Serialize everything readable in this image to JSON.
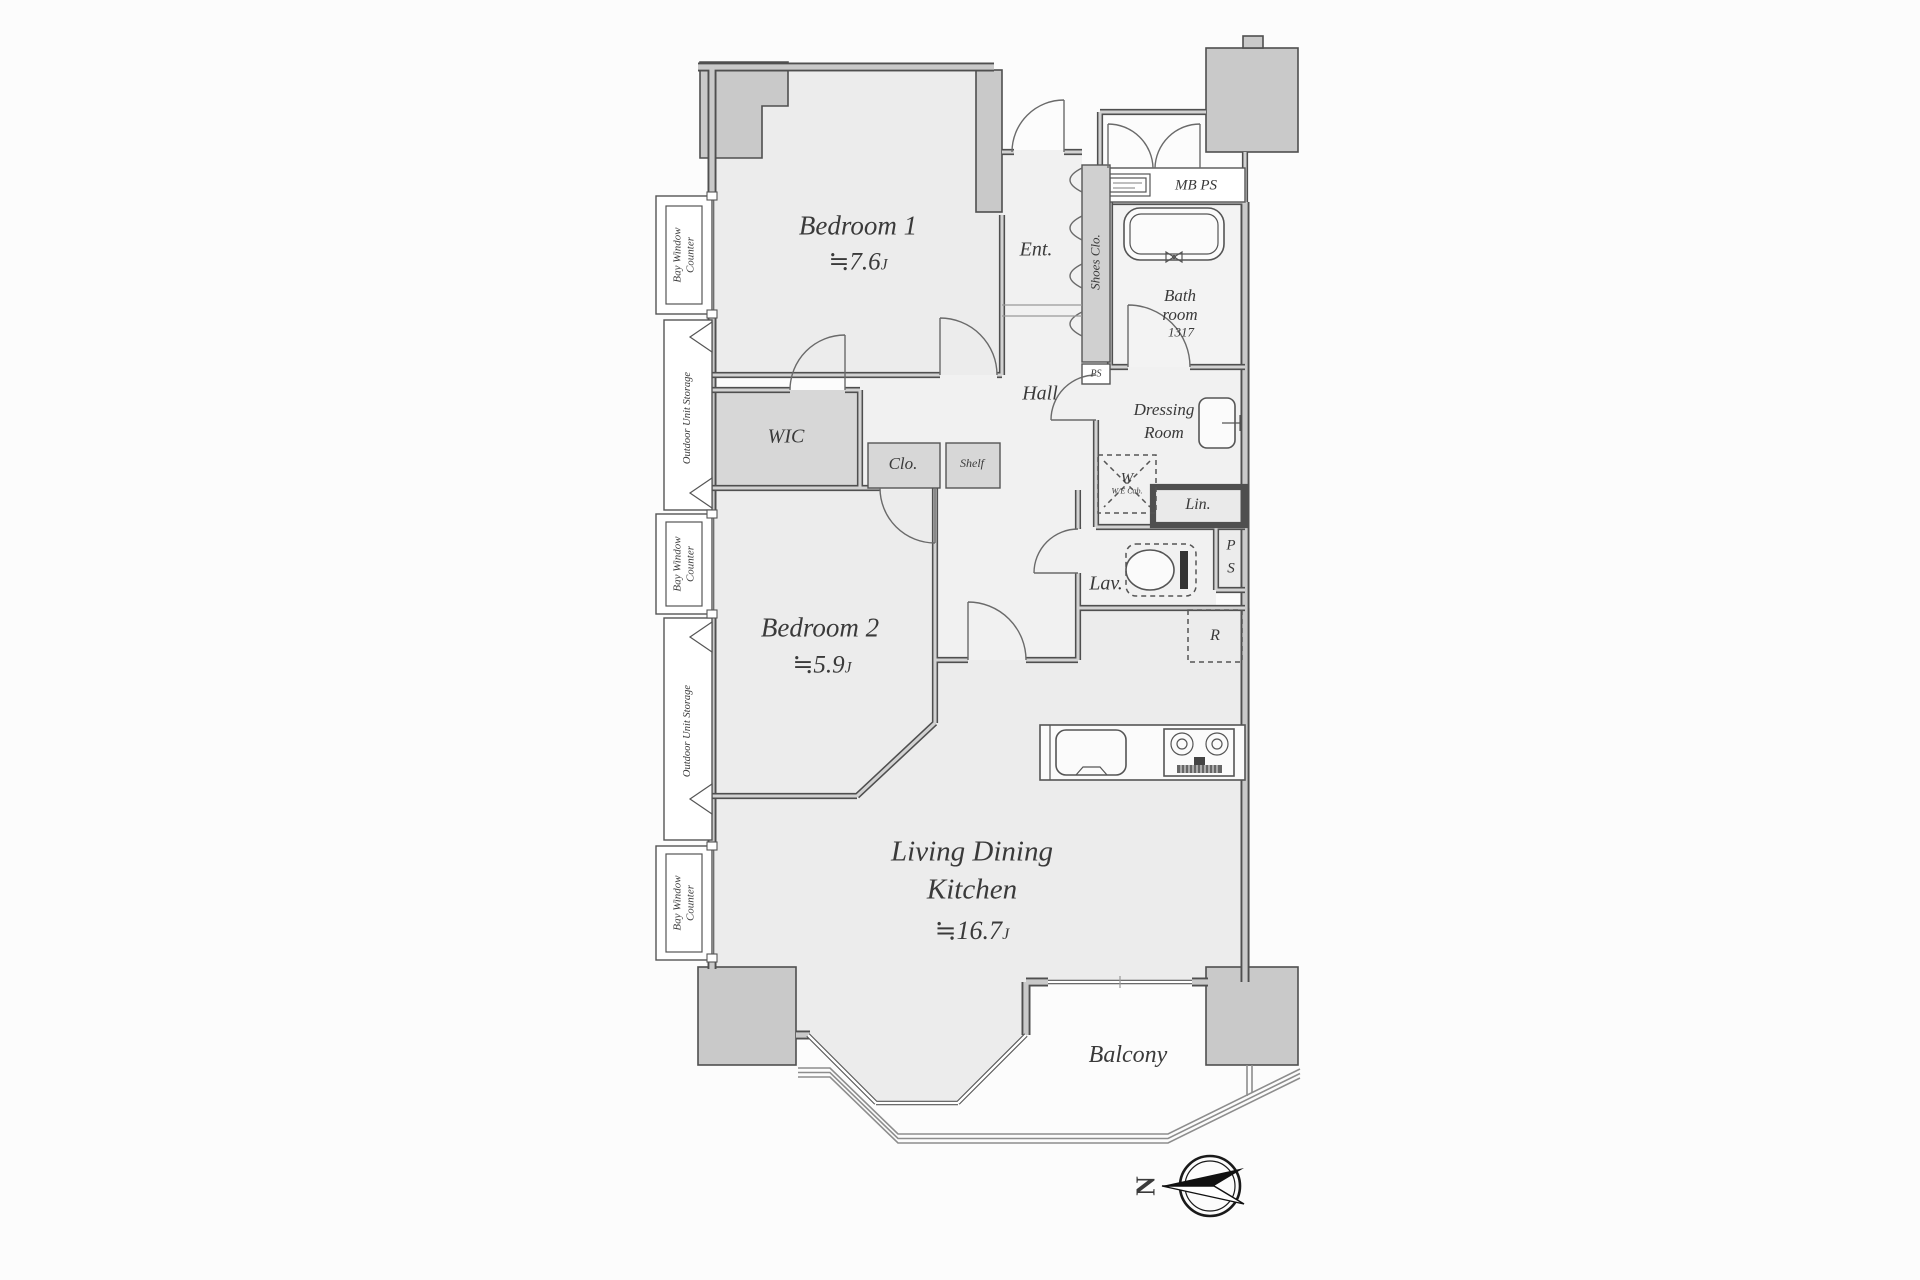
{
  "plan": {
    "rooms": {
      "bedroom1": {
        "name": "Bedroom 1",
        "area": "≒7.6",
        "unit": "J"
      },
      "bedroom2": {
        "name": "Bedroom 2",
        "area": "≒5.9",
        "unit": "J"
      },
      "ldk": {
        "line1": "Living Dining",
        "line2": "Kitchen",
        "area": "≒16.7",
        "unit": "J"
      },
      "balcony": {
        "name": "Balcony"
      },
      "entry": {
        "name": "Ent."
      },
      "hall": {
        "name": "Hall"
      },
      "bathroom": {
        "line1": "Bath",
        "line2": "room",
        "size": "1317"
      },
      "dressing": {
        "line1": "Dressing",
        "line2": "Room"
      },
      "lavatory": {
        "name": "Lav."
      },
      "wic": {
        "name": "WIC"
      },
      "closet": {
        "name": "Clo."
      },
      "shelf": {
        "name": "Shelf"
      },
      "linen": {
        "name": "Lin."
      },
      "shoes_closet": {
        "name": "Shoes Clo."
      },
      "fridge": {
        "name": "R"
      },
      "washer": {
        "name": "W",
        "caption": "W/E Cab."
      },
      "meter_box": {
        "name": "MB PS"
      },
      "pipe_space": {
        "name": "PS"
      },
      "pipe_shaft": {
        "p": "P",
        "s": "S"
      }
    },
    "left_features": {
      "bay_window_line1": "Bay Window",
      "bay_window_line2": "Counter",
      "outdoor_storage": "Outdoor Unit Storage"
    },
    "compass": {
      "north": "N"
    },
    "colors": {
      "wall": "#4f4f4f",
      "wall_fill": "#c9c9c9",
      "room_fill": "#ececec",
      "closet_fill": "#d7d7d7",
      "text": "#3a3a3a"
    }
  }
}
